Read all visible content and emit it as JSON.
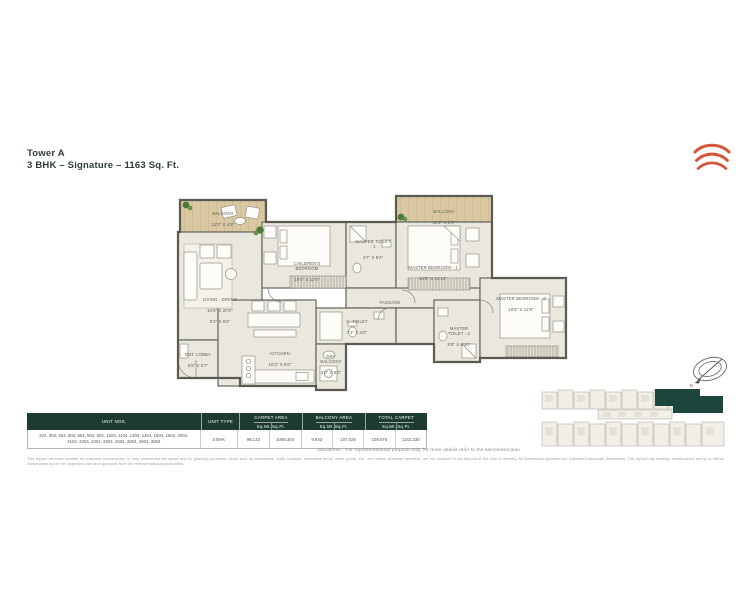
{
  "title": {
    "line1": "Tower A",
    "line2": "3 BHK – Signature – 1163 Sq. Ft."
  },
  "plan": {
    "labels": {
      "balcony1": {
        "name": "BALCONY",
        "dim": "11'0\" X 4'9\""
      },
      "living": {
        "name": "LIVING - DINING",
        "dim": "10'6\" X 20'0\"",
        "dim2": "5'2\" X 8'6\""
      },
      "children": {
        "name": "CHILDREN'S BEDROOM",
        "dim": "10'4\" X 12'0\""
      },
      "mtoilet1": {
        "name": "MASTER TOILET - 1",
        "dim": "4'7\" X 8'4\""
      },
      "balcony2": {
        "name": "BALCONY",
        "dim": "11'2\" X 2'9\""
      },
      "mbed1": {
        "name": "MASTER BEDROOM - 1",
        "dim": "10'8\" X 12'10\""
      },
      "passage": {
        "name": "PASSAGE"
      },
      "ctoilet": {
        "name": "C. TOILET",
        "dim": "7'1\" X 4'0\""
      },
      "kitchen": {
        "name": "KITCHEN",
        "dim": "10'2\" X 8'0\""
      },
      "drybalcony": {
        "name": "DRY BALCONY",
        "dim": "3'0\" X 8'0\""
      },
      "mbed2": {
        "name": "MASTER BEDROOM - 2",
        "dim": "10'6\" X 12'6\""
      },
      "mtoilet2": {
        "name": "MASTER TOILET - 2",
        "dim": "5'8\" X 8'10\""
      },
      "lobby": {
        "name": "ENT. LOBBY",
        "dim": "6'5\" X 5'7\""
      }
    },
    "compass": {
      "label": "N"
    }
  },
  "table": {
    "headers": {
      "unit_nos": "UNIT NOS.",
      "unit_type": "UNIT TYPE",
      "carpet": "CARPET AREA",
      "balcony": "BALCONY AREA",
      "total": "TOTAL CARPET",
      "sqmt": "Sq.Mt.",
      "sqft": "Sq.Ft."
    },
    "row": {
      "unit_nos": "204, 304, 404, 504, 604, 804, 904, 1004, 1104, 1304, 1404, 1504, 1604, 2004, 2104, 2304, 2404, 2504, 2604, 2804, 2904, 3004",
      "unit_type": "3 BHK",
      "carpet_sqmt": "98.133",
      "carpet_sqft": "1056.304",
      "balcony_sqmt": "9.943",
      "balcony_sqft": "107.026",
      "total_sqmt": "108.076",
      "total_sqft": "1163.330"
    }
  },
  "disclaimer": "Disclaimer : For representational purpose only, for more details refer to the sanctioned plan",
  "fine_print": "This layout has been created for customer convenience, to help understand the space and for planning purposes. Items such as boundaries, walls, furniture, decorative items, white goods, etc., are unless otherwise specified, are not provided in the flat/unit at the time of delivery. All dimensions specified are unfinished structural dimensions. The layout may undergo modifications during or before construction as per the approved plan and approvals from the relevant statutory authorities.",
  "colors": {
    "logo_accent": "#d4573b",
    "table_header": "#1d3b33",
    "keyplan_highlight": "#1c453d",
    "balcony_wood": "#d9c8a2"
  }
}
